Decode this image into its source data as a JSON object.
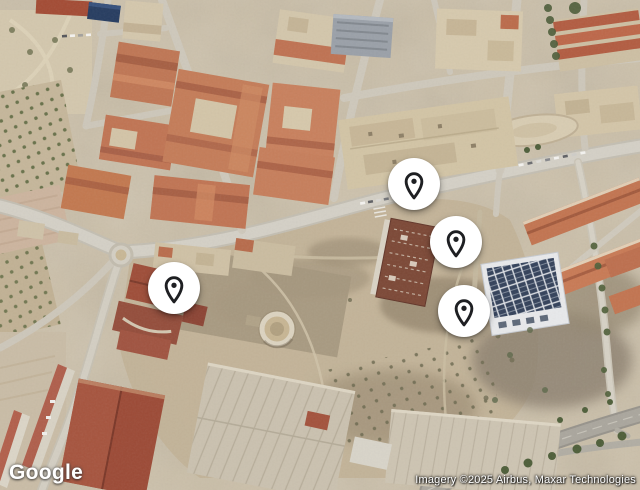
{
  "map": {
    "view_type": "satellite",
    "marker_diameter_px": 52,
    "markers": [
      {
        "id": 1,
        "x": 414,
        "y": 184
      },
      {
        "id": 2,
        "x": 456,
        "y": 242
      },
      {
        "id": 3,
        "x": 464,
        "y": 311
      },
      {
        "id": 4,
        "x": 174,
        "y": 288
      }
    ],
    "colors": {
      "marker_background": "#ffffff",
      "marker_pin": "#1e1f22",
      "terrain_base": "#cbbfa8"
    }
  },
  "footer": {
    "logo_text": "Google",
    "attribution_text": "Imagery ©2025 Airbus, Maxar Technologies"
  },
  "icons": {
    "marker_pin": "location-pin-icon",
    "logo": "google-wordmark"
  }
}
